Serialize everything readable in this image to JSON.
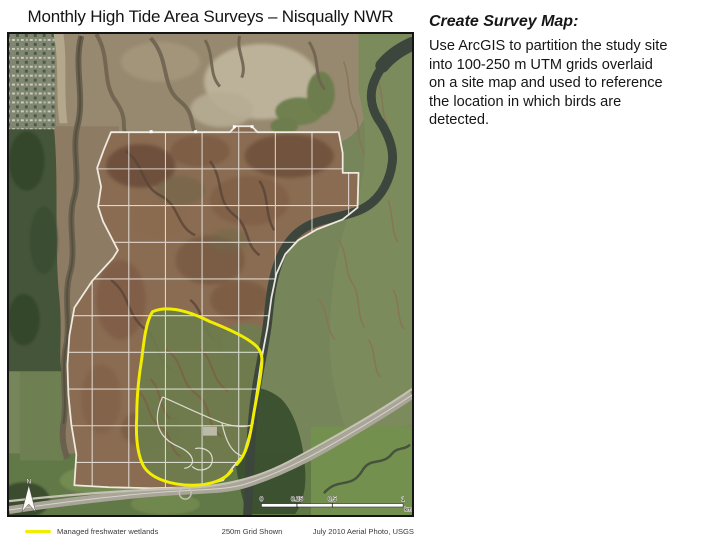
{
  "slide": {
    "title": "Monthly High Tide Area Surveys – Nisqually NWR"
  },
  "instructions": {
    "heading": "Create Survey Map:",
    "lines": [
      "Use ArcGIS to partition the study site",
      "into 100-250 m UTM grids overlaid",
      "on a site map and used to reference",
      "the location in which birds are",
      "detected."
    ]
  },
  "map": {
    "north_label": "N",
    "scalebar": {
      "labels": [
        "0",
        "0.25",
        "0.5",
        "1"
      ],
      "unit": "km"
    },
    "colors": {
      "wetlands_outline": "#F2EE00",
      "grid_lines": "#FFFFFF",
      "map_border": "#141414"
    }
  },
  "legend": {
    "wetlands_label": "Managed freshwater wetlands",
    "grid_label": "250m Grid Shown",
    "credit_label": "July 2010 Aerial Photo, USGS"
  }
}
